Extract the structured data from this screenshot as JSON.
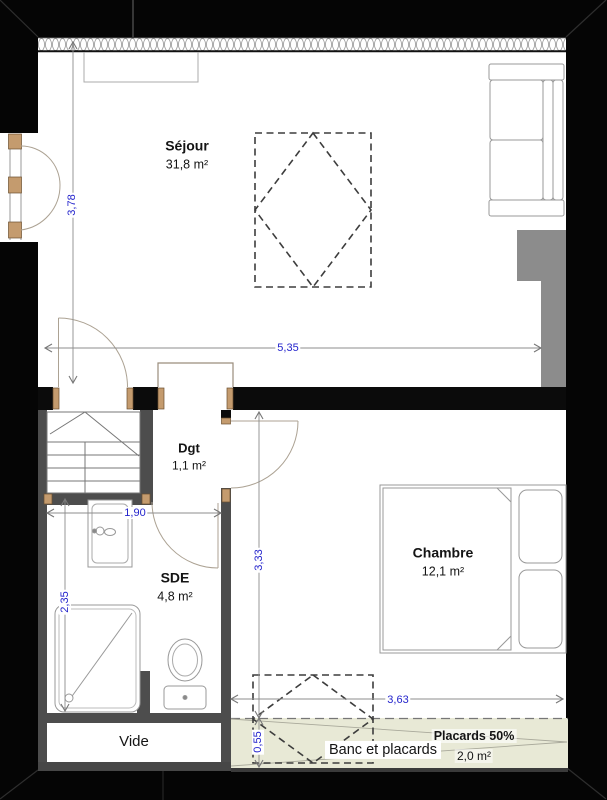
{
  "rooms": {
    "sejour": {
      "name": "Séjour",
      "area": "31,8 m²"
    },
    "dgt": {
      "name": "Dgt",
      "area": "1,1 m²"
    },
    "sde": {
      "name": "SDE",
      "area": "4,8 m²"
    },
    "chambre": {
      "name": "Chambre",
      "area": "12,1 m²"
    },
    "vide": {
      "name": "Vide"
    }
  },
  "storage": {
    "banc_label": "Banc et placards",
    "placards_label": "Placards 50%",
    "placards_area": "2,0 m²"
  },
  "dimensions": {
    "sejour_width": "5,35",
    "sejour_height": "3,78",
    "sde_width": "1,90",
    "sde_height": "2,35",
    "chambre_height": "3,33",
    "placards_width": "3,63",
    "placards_height": "0,55"
  },
  "colors": {
    "dimension_blue": "#2424cc",
    "placards_fill": "#e8e9d6",
    "wall_dark": "#4d4d4d",
    "post_tan": "#c49b6e"
  }
}
